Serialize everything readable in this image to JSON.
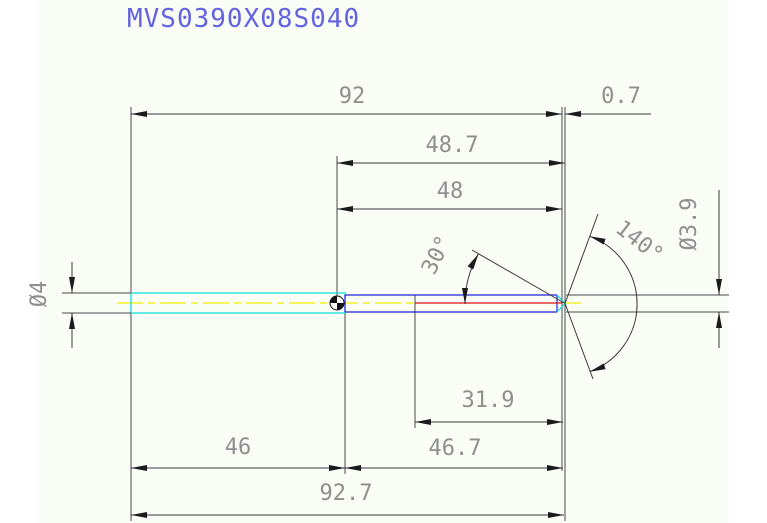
{
  "title": "MVS0390X08S040",
  "palette": {
    "background_tint": "#fafcf6",
    "title_text": "#6363e0",
    "dimension_text": "#8f8f8f",
    "drawing_lines": "#3a3a3a",
    "shaft_outline": "#00dcdc",
    "tip_section_outline": "#2222dd",
    "centerline": "#f0f000",
    "core_line": "#e01010"
  },
  "dimensions": {
    "overall_to_face": "92",
    "tip_protrusion": "0.7",
    "mid_to_tip_point": "48.7",
    "mid_to_face": "48",
    "tip_section_length": "31.9",
    "shaft_section_length": "46",
    "mid_to_tip_total": "46.7",
    "overall_total": "92.7",
    "tip_side_angle": "30°",
    "point_angle": "140°",
    "shaft_diameter": "Ø4",
    "tip_diameter": "Ø3.9"
  }
}
